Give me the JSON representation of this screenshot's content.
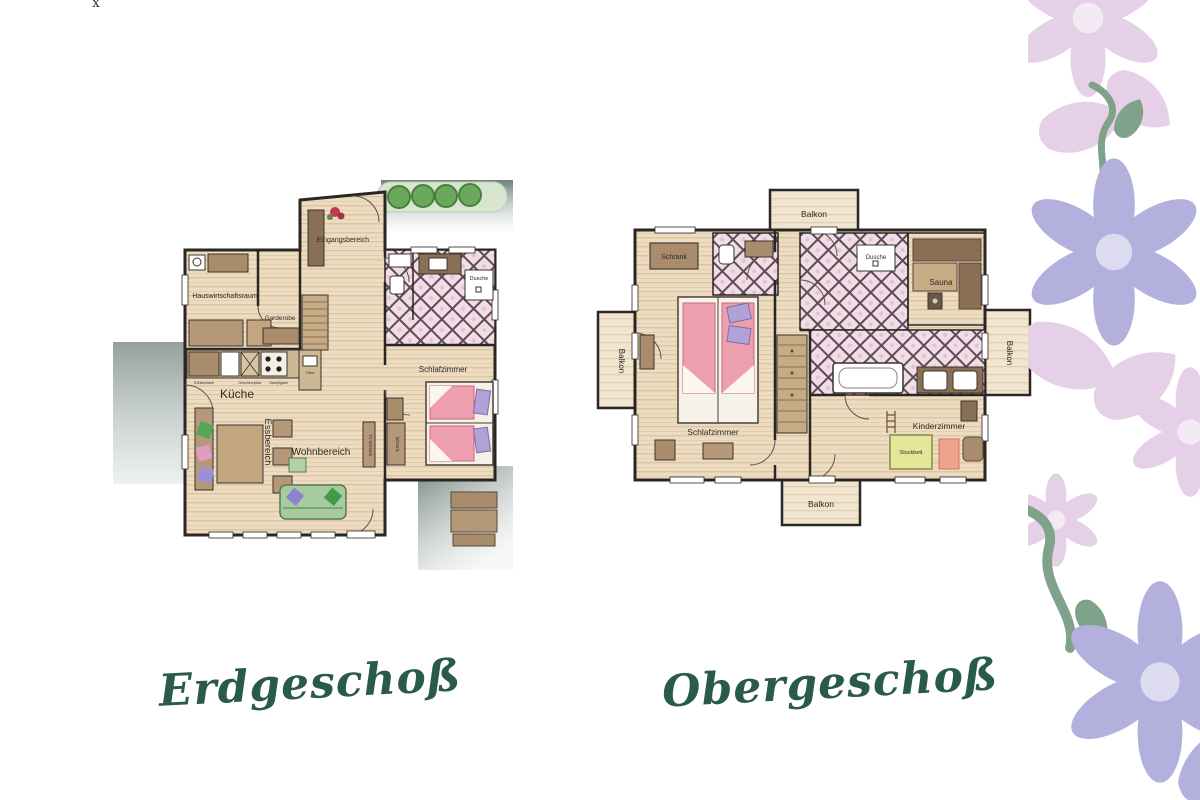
{
  "decor": {
    "top_mark": "x"
  },
  "titles": {
    "left": "Erdgeschoß",
    "right": "Obergeschoß"
  },
  "erdgeschoss": {
    "rooms": {
      "eingangsbereich": "Eingangsbereich",
      "hauswirtschaftsraum": "Hauswirtschaftsraum",
      "garderobe": "Garderobe",
      "dusche": "Dusche",
      "schlafzimmer": "Schlafzimmer",
      "kueche": "Küche",
      "essbereich": "Essbereich",
      "wohnbereich": "Wohnbereich"
    },
    "furniture": {
      "tv_schrank": "TV-Schrank",
      "schrank": "Schrank",
      "kuehlschrank": "Kühlschrank",
      "geschirrspueler": "Geschirrspüler",
      "dampfgarer": "Dampfgarer",
      "ofen": "Ofen"
    }
  },
  "obergeschoss": {
    "rooms": {
      "balkon": "Balkon",
      "schrank": "Schrank",
      "dusche": "Dusche",
      "sauna": "Sauna",
      "schlafzimmer": "Schlafzimmer",
      "kinderzimmer": "Kinderzimmer"
    },
    "furniture": {
      "stockbett": "Stockbett"
    }
  },
  "colors": {
    "floor": "#eddcc2",
    "floor_stripe": "#dcc6a2",
    "wall": "#2a2623",
    "tile_bg": "#f0dde6",
    "tile_line": "#5f4a55",
    "bed_pink": "#ee9fae",
    "pillow_purple": "#b2a1d6",
    "sofa_green": "#a7cba1",
    "wood_brown": "#a98c6c",
    "hedge_band": "#d8e6d0",
    "bush_green": "#6aa85c",
    "shadow_gray": "#788884",
    "title_green": "#2a5a4a",
    "floral_pink": "#e6d0e7",
    "floral_purple": "#b4b0de",
    "floral_green": "#7fa28b",
    "stockbett_yellow": "#e4e79a"
  }
}
